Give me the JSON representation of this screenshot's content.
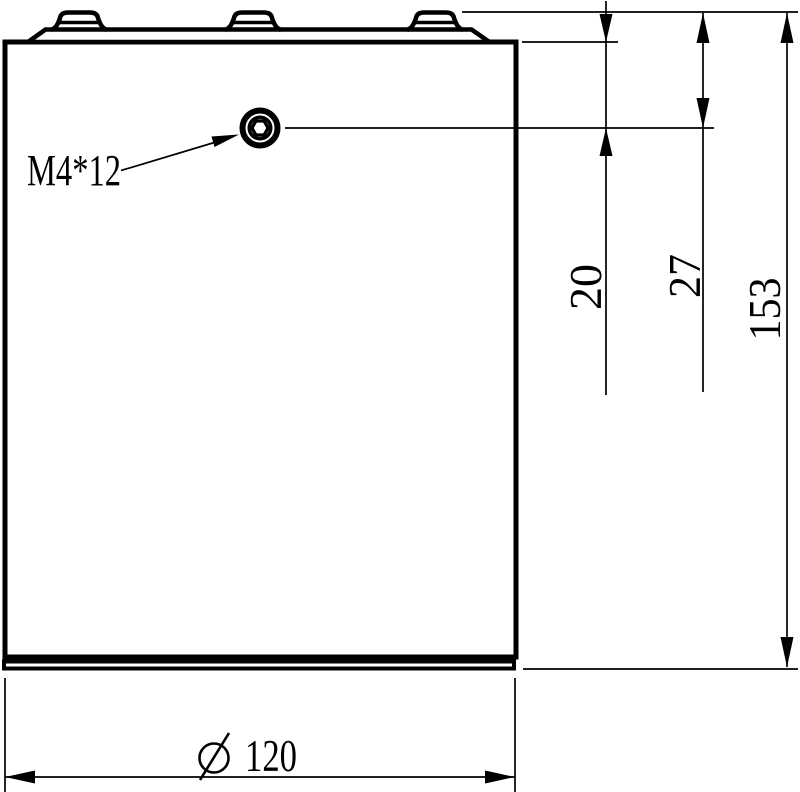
{
  "drawing": {
    "background_color": "#ffffff",
    "line_color": "#000000",
    "callout": {
      "label": "M4*12"
    },
    "dimensions": {
      "body_top_to_screw_center": {
        "label": "20",
        "orientation": "vertical"
      },
      "cap_top_to_screw_center": {
        "label": "27",
        "orientation": "vertical"
      },
      "overall_height": {
        "label": "153",
        "orientation": "vertical"
      },
      "diameter": {
        "symbol": "⌀",
        "label": "120",
        "orientation": "horizontal"
      }
    }
  }
}
